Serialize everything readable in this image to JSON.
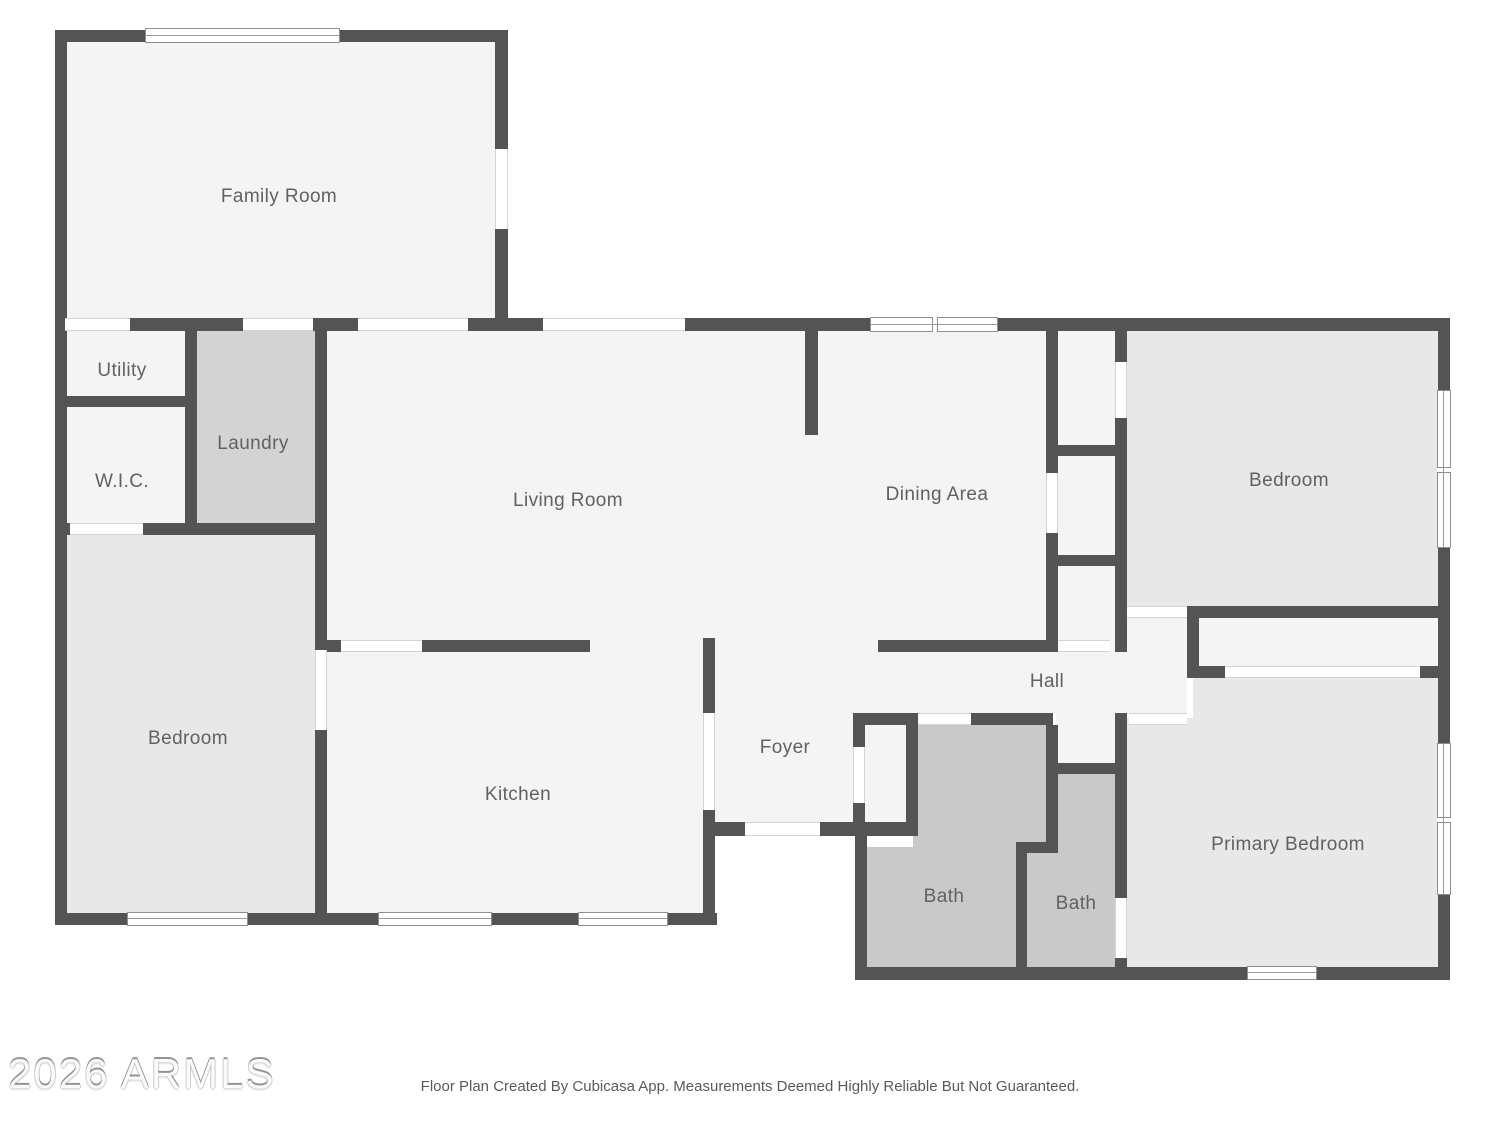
{
  "plan": {
    "rooms": [
      {
        "id": "family-room",
        "label": "Family Room"
      },
      {
        "id": "utility",
        "label": "Utility"
      },
      {
        "id": "laundry",
        "label": "Laundry"
      },
      {
        "id": "wic",
        "label": "W.I.C."
      },
      {
        "id": "living-room",
        "label": "Living Room"
      },
      {
        "id": "dining-area",
        "label": "Dining Area"
      },
      {
        "id": "bedroom-ne",
        "label": "Bedroom"
      },
      {
        "id": "bedroom-sw",
        "label": "Bedroom"
      },
      {
        "id": "kitchen",
        "label": "Kitchen"
      },
      {
        "id": "foyer",
        "label": "Foyer"
      },
      {
        "id": "hall",
        "label": "Hall"
      },
      {
        "id": "bath-1",
        "label": "Bath"
      },
      {
        "id": "bath-2",
        "label": "Bath"
      },
      {
        "id": "primary-bedroom",
        "label": "Primary Bedroom"
      }
    ],
    "watermark": "2026 ARMLS",
    "disclaimer": "Floor Plan Created By Cubicasa App. Measurements Deemed Highly Reliable But Not Guaranteed.",
    "colors": {
      "wall": "#545454",
      "room": "#f4f4f4",
      "bedroom": "#e8e8e8",
      "wet": "#c9c9c9",
      "laundry": "#d3d3d3",
      "label": "#616161"
    }
  }
}
